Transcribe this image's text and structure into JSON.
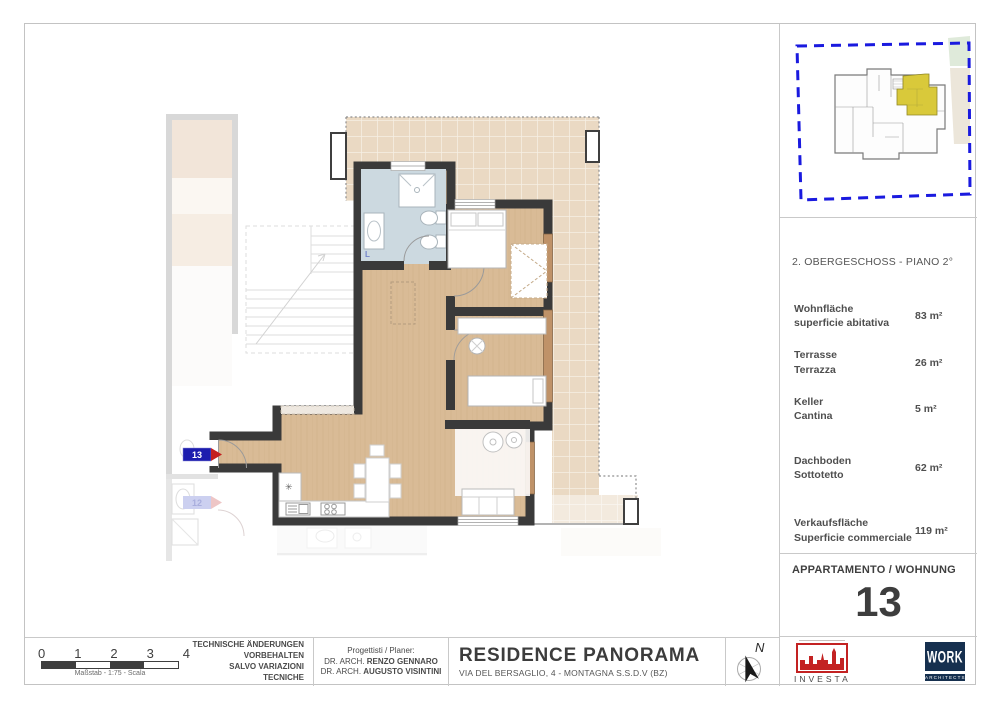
{
  "site_plan": {
    "description": "building footprint with highlighted unit inside dashed parcel boundary"
  },
  "info": {
    "floor_title": "2.  OBERGESCHOSS - PIANO 2°",
    "rows": [
      {
        "label_de": "Wohnfläche",
        "label_it": "superficie abitativa",
        "value": "83 m²"
      },
      {
        "label_de": "Terrasse",
        "label_it": "Terrazza",
        "value": "26 m²"
      },
      {
        "label_de": "Keller",
        "label_it": "Cantina",
        "value": "5 m²"
      },
      {
        "label_de": "Dachboden",
        "label_it": "Sottotetto",
        "value": "62 m²"
      },
      {
        "label_de": "Verkaufsfläche",
        "label_it": "Superficie commerciale",
        "value": "119 m²"
      }
    ]
  },
  "apartment": {
    "label": "APPARTAMENTO / WOHNUNG",
    "number": "13"
  },
  "plan": {
    "unit_label": "13",
    "neighbor_label": "12",
    "bath_label": "L"
  },
  "titleblock": {
    "scale": {
      "ticks": [
        "0",
        "1",
        "2",
        "3",
        "4"
      ],
      "caption": "Maßstab - 1:75 - Scala"
    },
    "notes": [
      "TECHNISCHE ÄNDERUNGEN",
      "VORBEHALTEN",
      "SALVO VARIAZIONI TECNICHE"
    ],
    "planners": {
      "heading": "Progettisti / Planer:",
      "line1_prefix": "DR. ARCH. ",
      "line1_name": "RENZO GENNARO",
      "line2_prefix": "DR. ARCH. ",
      "line2_name": "AUGUSTO VISINTINI"
    },
    "project": {
      "title": "RESIDENCE PANORAMA",
      "address": "VIA DEL BERSAGLIO, 4 - MONTAGNA S.S.D.V (BZ)"
    },
    "north_label": "N"
  },
  "logos": {
    "investa": {
      "name": "INVESTA"
    },
    "work": {
      "name": "WORK",
      "sub": "ARCHITECTS"
    }
  },
  "colors": {
    "wall": "#3a3a3a",
    "wood": "#d9bb96",
    "tile": "#ead9c3",
    "bathroom": "#ccd9e0",
    "highlight": "#d9c93a",
    "boundary": "#1a1adf",
    "label_navy": "#1c1cae",
    "label_red": "#c41f1f"
  }
}
